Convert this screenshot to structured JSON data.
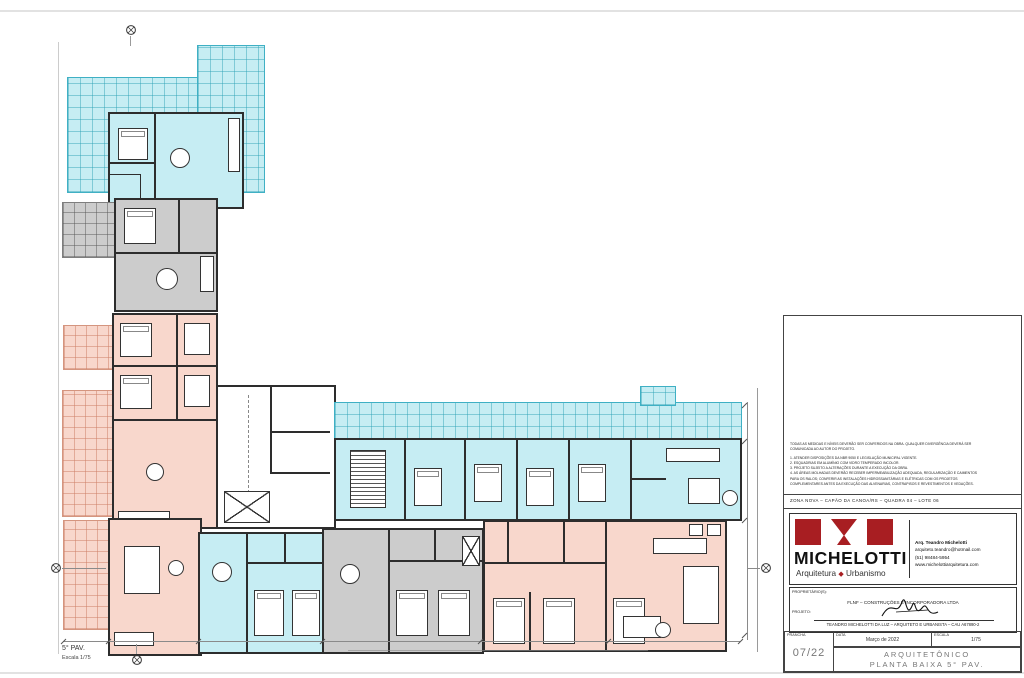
{
  "plan": {
    "floor_label": "5° PAV.",
    "scale_label": "Escala 1/75",
    "colors": {
      "unit_cyan": "#c6edf3",
      "unit_gray": "#cccccc",
      "unit_salmon": "#f8d7cc",
      "wall": "#2d2d2d",
      "brand_red": "#a81e22"
    }
  },
  "titleblock": {
    "notes": [
      "TODAS AS MEDIDAS E NÍVEIS DEVERÃO SER CONFERIDOS NA OBRA. QUALQUER DIVERGÊNCIA DEVERÁ SER",
      "COMUNICADA AO AUTOR DO PROJETO.",
      "1. ATENDER DISPOSIÇÕES DA NBR 9050 E LEGISLAÇÃO MUNICIPAL VIGENTE.",
      "2. ESQUADRIAS EM ALUMÍNIO COM VIDRO TEMPERADO INCOLOR.",
      "3. PROJETO SUJEITO A ALTERAÇÕES DURANTE A EXECUÇÃO DA OBRA.",
      "4. AS ÁREAS MOLHADAS DEVERÃO RECEBER IMPERMEABILIZAÇÃO ADEQUADA, REGULARIZAÇÃO E CAIMENTOS",
      "PARA OS RALOS; CONFERIR AS INSTALAÇÕES HIDROSSANITÁRIAS E ELÉTRICAS COM OS PROJETOS",
      "COMPLEMENTARES ANTES DA EXECUÇÃO DAS ALVENARIAS, CONTRAPISOS E REVESTIMENTOS E VEDAÇÕES."
    ],
    "location_line": "ZONA NOVA  –  CAPÃO DA CANOA/RS  –  QUADRA 04  –  LOTE 06",
    "brand": {
      "name": "MICHELOTTI",
      "tagline_left": "Arquitetura",
      "diamond_icon": "◆",
      "tagline_right": "Urbanismo"
    },
    "contact": {
      "architect": "Arq. Teandro Michelotti",
      "email": "arquiteto.teandro@hotmail.com",
      "phone": "(51) 98484-5954",
      "website": "www.michelottiarquitetura.com"
    },
    "owner_label": "PROPRIETÁRIO(S):",
    "owner_value": "FLNF – CONSTRUÇÕES E INCORPORADORA LTDA",
    "project_label": "PROJETO:",
    "project_value": "TEANDRO MICHELOTTI DA LUZ – ARQUITETO E URBANISTA – CAU A67890-2",
    "fields": {
      "sheet_label": "PRANCHA",
      "sheet_value": "07/22",
      "date_label": "DATA",
      "date_value": "Março de 2022",
      "scale_label": "ESCALA",
      "scale_value": "1/75"
    },
    "drawing_title_line1": "ARQUITETÔNICO",
    "drawing_title_line2": "PLANTA BAIXA 5° PAV."
  }
}
